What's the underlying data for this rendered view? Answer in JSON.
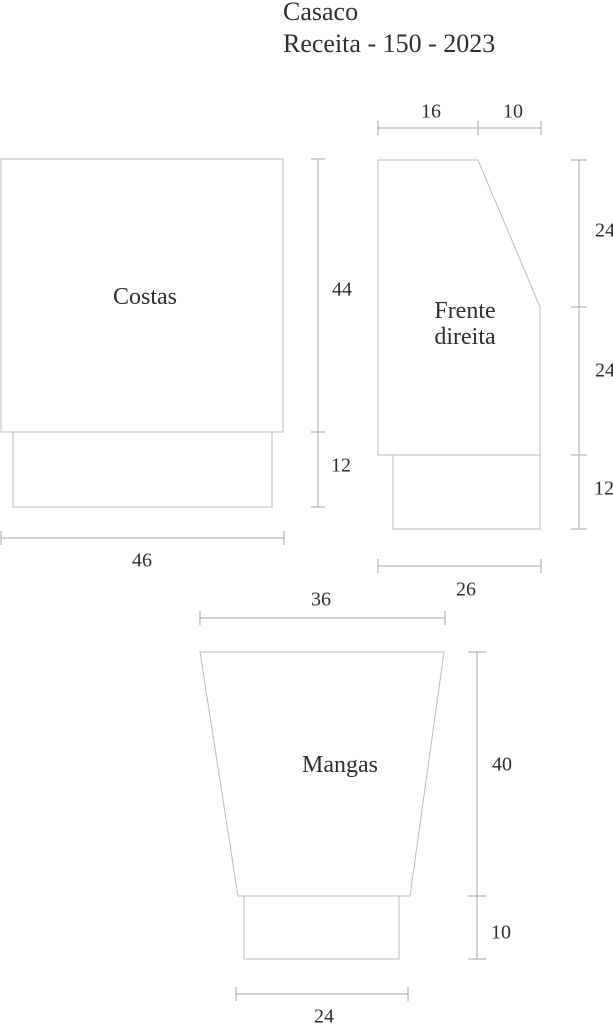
{
  "title": {
    "line1": "Casaco",
    "line2": "Receita - 150 - 2023"
  },
  "pieces": {
    "costas": {
      "label": "Costas",
      "body_height": "44",
      "ribbing_height": "12",
      "width": "46"
    },
    "frente_direita": {
      "label_line1": "Frente",
      "label_line2": "direita",
      "shoulder_width": "16",
      "neck_width": "10",
      "upper_side_height": "24",
      "lower_side_height": "24",
      "ribbing_height": "12",
      "width": "26"
    },
    "mangas": {
      "label": "Mangas",
      "top_width": "36",
      "body_height": "40",
      "ribbing_height": "10",
      "cuff_width": "24"
    }
  },
  "colors": {
    "outline": "#bcbcbc",
    "dimension_line": "#a6a6a6",
    "text": "#2f2f2f",
    "background": "#ffffff"
  }
}
